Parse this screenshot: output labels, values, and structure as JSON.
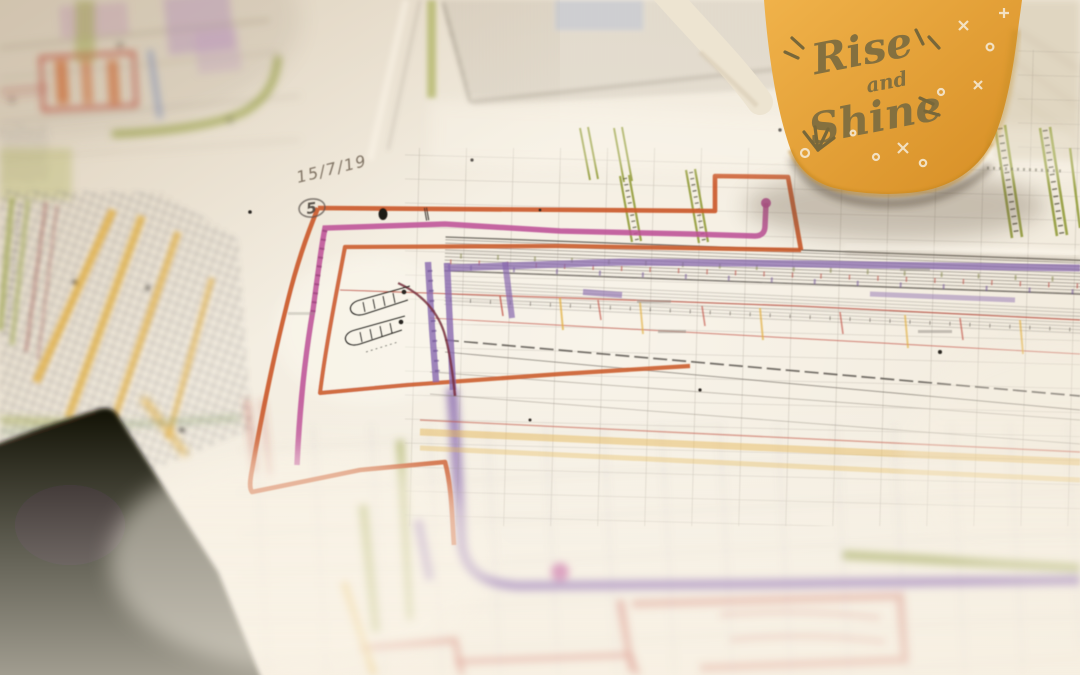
{
  "image": {
    "kind": "photograph",
    "description": "Close-up photo of coloured engineering blueprint drawings spread on a table, with a yellow 'Rise and Shine' coffee mug at top right and the dark corner of a phone/tablet at bottom left",
    "mug": {
      "line1": "Rise",
      "line2": "and",
      "line3": "Shine",
      "body_color_light": "#F0B24A",
      "body_color_dark": "#D78F26",
      "lettering_color": "#84703F",
      "handle_color": "#EDE4D1",
      "sparkle_color": "#F6EDDB"
    },
    "blueprint": {
      "handwritten_date": "15/7/19",
      "circled_number": "5",
      "double_tick_mark": "‖",
      "paper_color": "#F0E8D9",
      "marker_colors": {
        "orange": "#CB5A2A",
        "magenta": "#BC4E95",
        "purple": "#8768AE",
        "olive": "#9CA44B",
        "yellow": "#E2AE3E",
        "red": "#BE4A3C",
        "blue": "#6C86BF"
      }
    },
    "phone": {
      "color": "#0C0806"
    }
  }
}
